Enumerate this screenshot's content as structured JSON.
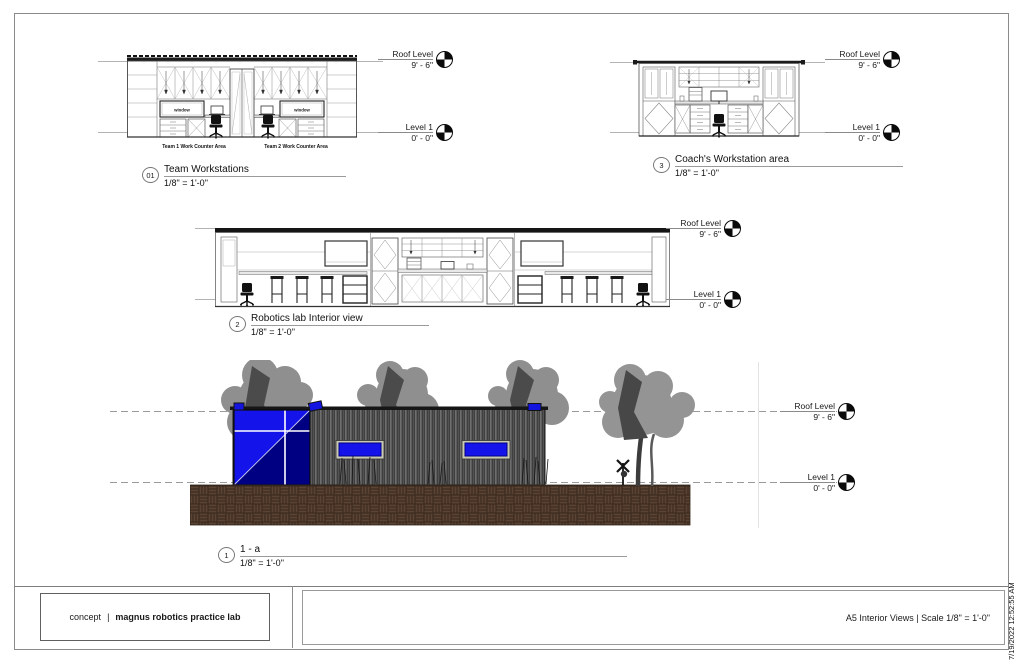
{
  "sheet": {
    "timestamp": "7/19/2022 12:52:55 AM",
    "title_block": {
      "phase": "concept",
      "separator": "|",
      "project": "magnus robotics practice lab",
      "sheet_info": "A5  Interior Views  |  Scale 1/8\" = 1'-0\""
    }
  },
  "levels": {
    "roof": {
      "name": "Roof Level",
      "elev": "9' - 6\""
    },
    "l1": {
      "name": "Level 1",
      "elev": "0' - 0\""
    }
  },
  "views": {
    "team": {
      "number": "01",
      "title": "Team Workstations",
      "scale": "1/8\" = 1'-0\"",
      "area1": "Team 1 Work Counter Area",
      "area2": "Team 2 Work Counter Area",
      "window_label": "window"
    },
    "coach": {
      "number": "3",
      "title": "Coach's Workstation area",
      "scale": "1/8\" = 1'-0\""
    },
    "lab": {
      "number": "2",
      "title": "Robotics lab Interior view",
      "scale": "1/8\" = 1'-0\""
    },
    "exterior": {
      "number": "1",
      "title": "1 - a",
      "scale": "1/8\" = 1'-0\""
    }
  },
  "colors": {
    "glass_blue": "#1414ea",
    "glass_shadow": "#000082",
    "siding_gray": "#3f3f3f",
    "brick_brown": "#5a4332",
    "tree_gray": "#8f8f8f"
  }
}
